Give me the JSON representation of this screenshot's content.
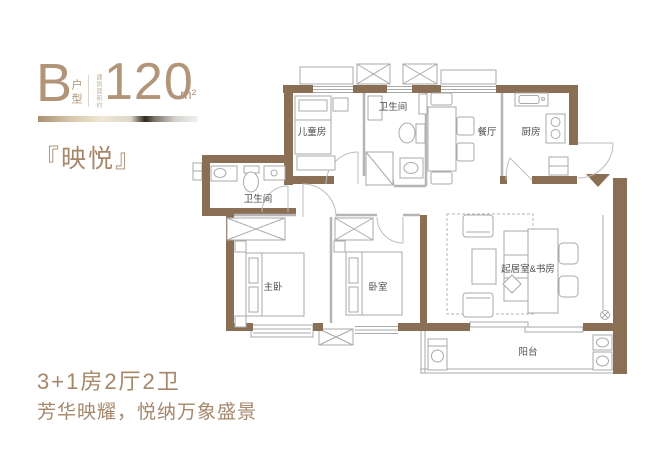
{
  "header": {
    "unit_letter": "B",
    "unit_type_label": "户型",
    "area_note": "建筑面积约",
    "area_value": "120",
    "area_unit": "m²"
  },
  "project_name": "『映悦』",
  "footer": {
    "layout_summary": "3+1房2厅2卫",
    "tagline": "芳华映耀，悦纳万象盛景"
  },
  "floorplan": {
    "rooms": [
      {
        "id": "children-room",
        "label": "儿童房"
      },
      {
        "id": "bathroom-main",
        "label": "卫生间"
      },
      {
        "id": "dining-room",
        "label": "餐厅"
      },
      {
        "id": "kitchen",
        "label": "厨房"
      },
      {
        "id": "bathroom-second",
        "label": "卫生间"
      },
      {
        "id": "master-bedroom",
        "label": "主卧"
      },
      {
        "id": "bedroom",
        "label": "卧室"
      },
      {
        "id": "living-study",
        "label": "起居室&书房"
      },
      {
        "id": "balcony",
        "label": "阳台"
      }
    ]
  },
  "colors": {
    "wall_brown": "#8a6f55",
    "accent_tan": "#b29478",
    "text_brown": "#a5876a",
    "line_gray": "#a9a9a9"
  }
}
